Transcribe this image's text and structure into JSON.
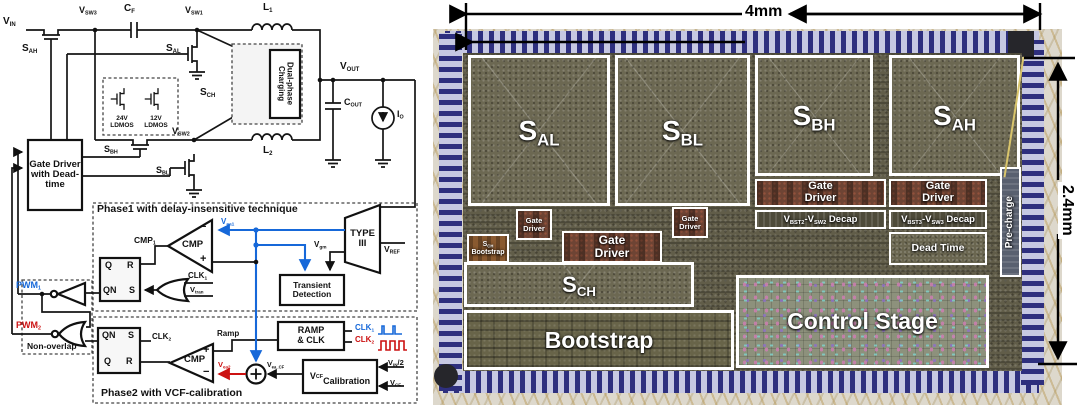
{
  "schematic": {
    "power": {
      "vin": "V<sub>IN</sub>",
      "vsw3": "V<sub>SW3</sub>",
      "cf": "C<sub>F</sub>",
      "vsw1": "V<sub>SW1</sub>",
      "l1": "L<sub>1</sub>",
      "sah": "S<sub>AH</sub>",
      "sal": "S<sub>AL</sub>",
      "sch": "S<sub>CH</sub>",
      "dual_phase": "Dual-phase Charging",
      "vout": "V<sub>OUT</sub>",
      "cout": "C<sub>OUT</sub>",
      "io": "I<sub>O</sub>",
      "vsw2": "V<sub>SW2</sub>",
      "l2": "L<sub>2</sub>",
      "ldmos24": "24V<br>LDMOS",
      "ldmos12": "12V<br>LDMOS",
      "sbh": "S<sub>BH</sub>",
      "sbl": "S<sub>BL</sub>",
      "gate_driver": "Gate Driver with Dead-time"
    },
    "phase1": {
      "title": "Phase1 with delay-insensitive technique",
      "cmp1": "CMP<sub>1</sub>",
      "cmp": "CMP",
      "minus": "−",
      "plus": "+",
      "q": "Q",
      "r": "R",
      "qn": "QN",
      "s": "S",
      "clk1": "CLK<sub>1</sub>",
      "vtran": "V<sub>tran</sub>",
      "vea1": "V<sub>ea1</sub>",
      "type3": "TYPE III",
      "vgm": "V<sub>gm</sub>",
      "vref": "V<sub>REF</sub>",
      "transient": "Transient Detection"
    },
    "nonoverlap": {
      "pwm1": "PWM<sub>1</sub>",
      "pwm2": "PWM<sub>2</sub>",
      "label": "Non-overlap"
    },
    "phase2": {
      "title": "Phase2 with VCF-calibration",
      "qn": "QN",
      "s": "S",
      "q": "Q",
      "r": "R",
      "clk2": "CLK<sub>2</sub>",
      "cmp": "CMP",
      "plus": "+",
      "minus": "−",
      "ramp": "Ramp",
      "ramp_clk": "RAMP<br>& CLK",
      "clk1_leg": "CLK<sub>1</sub>",
      "clk2_leg": "CLK<sub>2</sub>",
      "vea2": "V<sub>ea2</sub>",
      "vea_cf": "V<sub>ea_CF</sub>",
      "vcf_cal": "V<sub>CF</sub><br>Calibration",
      "vin2": "V<sub>IN</sub>/2",
      "vcf": "V<sub>CF</sub>"
    }
  },
  "die": {
    "dim_width": "4mm",
    "dim_height": "2.4mm",
    "blocks": {
      "sal": "S<sub>AL</sub>",
      "sbl": "S<sub>BL</sub>",
      "sbh": "S<sub>BH</sub>",
      "sah": "S<sub>AH</sub>",
      "gate_driver": "Gate<br>Driver",
      "sch_bootstrap": "S<sub>CH</sub><br>Bootstrap",
      "sch": "S<sub>CH</sub>",
      "decap2": "V<sub>BST2</sub>-V<sub>SW2</sub> Decap",
      "decap3": "V<sub>BST3</sub>-V<sub>SW3</sub> Decap",
      "dead_time": "Dead Time",
      "precharge": "Pre-charge",
      "bootstrap": "Bootstrap",
      "control_stage": "Control Stage"
    }
  },
  "colors": {
    "phase1_accent": "#1668d9",
    "phase2_accent": "#cc1111"
  }
}
